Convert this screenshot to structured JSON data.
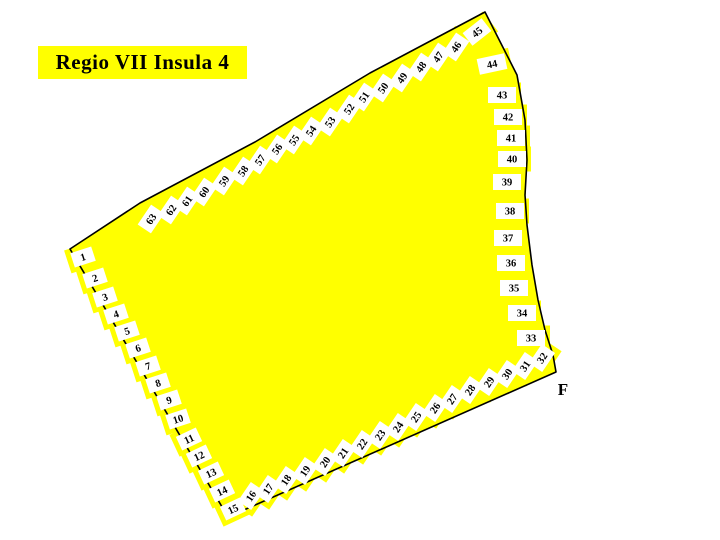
{
  "title": "Regio VII Insula 4",
  "region_label": "F",
  "colors": {
    "insula_fill": "#ffff00",
    "outline": "#000000",
    "entrance_box_fill": "#ffffff",
    "number_color": "#000000",
    "background": "#ffffff"
  },
  "map": {
    "description": "Plan of Pompeii Regio VII Insula 4 with numbered entrance doorways around the perimeter",
    "outline_points": [
      [
        70,
        249
      ],
      [
        140,
        203
      ],
      [
        255,
        142
      ],
      [
        370,
        73
      ],
      [
        485,
        12
      ],
      [
        517,
        75
      ],
      [
        525,
        120
      ],
      [
        527,
        160
      ],
      [
        525,
        195
      ],
      [
        527,
        225
      ],
      [
        532,
        265
      ],
      [
        538,
        300
      ],
      [
        545,
        330
      ],
      [
        553,
        355
      ],
      [
        556,
        372
      ],
      [
        228,
        517
      ]
    ],
    "entrances": [
      {
        "n": "1",
        "x": 83,
        "y": 257,
        "r": -18,
        "w": 22,
        "h": 15
      },
      {
        "n": "2",
        "x": 95,
        "y": 278,
        "r": -18,
        "w": 22,
        "h": 15
      },
      {
        "n": "3",
        "x": 105,
        "y": 297,
        "r": -18,
        "w": 22,
        "h": 15
      },
      {
        "n": "4",
        "x": 116,
        "y": 314,
        "r": -18,
        "w": 22,
        "h": 15
      },
      {
        "n": "5",
        "x": 127,
        "y": 331,
        "r": -18,
        "w": 22,
        "h": 15
      },
      {
        "n": "6",
        "x": 138,
        "y": 348,
        "r": -18,
        "w": 22,
        "h": 15
      },
      {
        "n": "7",
        "x": 148,
        "y": 366,
        "r": -18,
        "w": 22,
        "h": 15
      },
      {
        "n": "8",
        "x": 158,
        "y": 383,
        "r": -18,
        "w": 22,
        "h": 15
      },
      {
        "n": "9",
        "x": 169,
        "y": 400,
        "r": -18,
        "w": 22,
        "h": 15
      },
      {
        "n": "10",
        "x": 178,
        "y": 419,
        "r": -18,
        "w": 22,
        "h": 15
      },
      {
        "n": "11",
        "x": 189,
        "y": 439,
        "r": -25,
        "w": 22,
        "h": 15
      },
      {
        "n": "12",
        "x": 199,
        "y": 456,
        "r": -25,
        "w": 22,
        "h": 15
      },
      {
        "n": "13",
        "x": 211,
        "y": 473,
        "r": -25,
        "w": 22,
        "h": 15
      },
      {
        "n": "14",
        "x": 222,
        "y": 491,
        "r": -25,
        "w": 22,
        "h": 15
      },
      {
        "n": "15",
        "x": 233,
        "y": 509,
        "r": -25,
        "w": 22,
        "h": 15
      },
      {
        "n": "16",
        "x": 251,
        "y": 496,
        "r": -56,
        "w": 23,
        "h": 16
      },
      {
        "n": "17",
        "x": 268,
        "y": 489,
        "r": -56,
        "w": 23,
        "h": 16
      },
      {
        "n": "18",
        "x": 286,
        "y": 480,
        "r": -56,
        "w": 23,
        "h": 16
      },
      {
        "n": "19",
        "x": 305,
        "y": 471,
        "r": -56,
        "w": 23,
        "h": 16
      },
      {
        "n": "20",
        "x": 325,
        "y": 462,
        "r": -56,
        "w": 23,
        "h": 16
      },
      {
        "n": "21",
        "x": 343,
        "y": 453,
        "r": -56,
        "w": 23,
        "h": 16
      },
      {
        "n": "22",
        "x": 362,
        "y": 444,
        "r": -56,
        "w": 23,
        "h": 16
      },
      {
        "n": "23",
        "x": 380,
        "y": 435,
        "r": -56,
        "w": 23,
        "h": 16
      },
      {
        "n": "24",
        "x": 398,
        "y": 427,
        "r": -56,
        "w": 23,
        "h": 16
      },
      {
        "n": "25",
        "x": 416,
        "y": 417,
        "r": -56,
        "w": 23,
        "h": 16
      },
      {
        "n": "26",
        "x": 435,
        "y": 408,
        "r": -56,
        "w": 23,
        "h": 16
      },
      {
        "n": "27",
        "x": 452,
        "y": 399,
        "r": -56,
        "w": 23,
        "h": 16
      },
      {
        "n": "28",
        "x": 470,
        "y": 390,
        "r": -56,
        "w": 23,
        "h": 16
      },
      {
        "n": "29",
        "x": 489,
        "y": 382,
        "r": -56,
        "w": 23,
        "h": 16
      },
      {
        "n": "30",
        "x": 507,
        "y": 374,
        "r": -56,
        "w": 23,
        "h": 16
      },
      {
        "n": "31",
        "x": 525,
        "y": 366,
        "r": -56,
        "w": 23,
        "h": 16
      },
      {
        "n": "32",
        "x": 542,
        "y": 358,
        "r": -56,
        "w": 23,
        "h": 16
      },
      {
        "n": "33",
        "x": 531,
        "y": 338,
        "r": 0,
        "w": 28,
        "h": 16
      },
      {
        "n": "34",
        "x": 522,
        "y": 313,
        "r": 0,
        "w": 28,
        "h": 16
      },
      {
        "n": "35",
        "x": 514,
        "y": 288,
        "r": 0,
        "w": 28,
        "h": 16
      },
      {
        "n": "36",
        "x": 511,
        "y": 263,
        "r": 0,
        "w": 28,
        "h": 16
      },
      {
        "n": "37",
        "x": 508,
        "y": 238,
        "r": 0,
        "w": 28,
        "h": 16
      },
      {
        "n": "38",
        "x": 510,
        "y": 211,
        "r": 0,
        "w": 28,
        "h": 16
      },
      {
        "n": "39",
        "x": 507,
        "y": 182,
        "r": 0,
        "w": 28,
        "h": 16
      },
      {
        "n": "40",
        "x": 512,
        "y": 159,
        "r": 0,
        "w": 28,
        "h": 16
      },
      {
        "n": "41",
        "x": 511,
        "y": 138,
        "r": 0,
        "w": 28,
        "h": 16
      },
      {
        "n": "42",
        "x": 508,
        "y": 117,
        "r": 0,
        "w": 28,
        "h": 16
      },
      {
        "n": "43",
        "x": 502,
        "y": 95,
        "r": 0,
        "w": 28,
        "h": 16
      },
      {
        "n": "44",
        "x": 492,
        "y": 64,
        "r": -12,
        "w": 28,
        "h": 16
      },
      {
        "n": "45",
        "x": 477,
        "y": 32,
        "r": -38,
        "w": 24,
        "h": 16
      },
      {
        "n": "46",
        "x": 456,
        "y": 47,
        "r": -56,
        "w": 24,
        "h": 16
      },
      {
        "n": "47",
        "x": 438,
        "y": 57,
        "r": -56,
        "w": 24,
        "h": 16
      },
      {
        "n": "48",
        "x": 421,
        "y": 67,
        "r": -56,
        "w": 24,
        "h": 16
      },
      {
        "n": "49",
        "x": 402,
        "y": 78,
        "r": -56,
        "w": 24,
        "h": 16
      },
      {
        "n": "50",
        "x": 383,
        "y": 88,
        "r": -56,
        "w": 24,
        "h": 16
      },
      {
        "n": "51",
        "x": 364,
        "y": 97,
        "r": -56,
        "w": 24,
        "h": 16
      },
      {
        "n": "52",
        "x": 349,
        "y": 109,
        "r": -56,
        "w": 24,
        "h": 16
      },
      {
        "n": "53",
        "x": 330,
        "y": 122,
        "r": -56,
        "w": 24,
        "h": 16
      },
      {
        "n": "54",
        "x": 311,
        "y": 131,
        "r": -56,
        "w": 24,
        "h": 16
      },
      {
        "n": "55",
        "x": 294,
        "y": 140,
        "r": -56,
        "w": 24,
        "h": 16
      },
      {
        "n": "56",
        "x": 277,
        "y": 149,
        "r": -56,
        "w": 24,
        "h": 16
      },
      {
        "n": "57",
        "x": 260,
        "y": 160,
        "r": -56,
        "w": 24,
        "h": 16
      },
      {
        "n": "58",
        "x": 243,
        "y": 171,
        "r": -56,
        "w": 24,
        "h": 16
      },
      {
        "n": "59",
        "x": 224,
        "y": 181,
        "r": -56,
        "w": 24,
        "h": 16
      },
      {
        "n": "60",
        "x": 204,
        "y": 192,
        "r": -56,
        "w": 24,
        "h": 16
      },
      {
        "n": "61",
        "x": 187,
        "y": 201,
        "r": -56,
        "w": 24,
        "h": 16
      },
      {
        "n": "62",
        "x": 171,
        "y": 210,
        "r": -56,
        "w": 24,
        "h": 16
      },
      {
        "n": "63",
        "x": 151,
        "y": 219,
        "r": -56,
        "w": 24,
        "h": 16
      }
    ]
  }
}
